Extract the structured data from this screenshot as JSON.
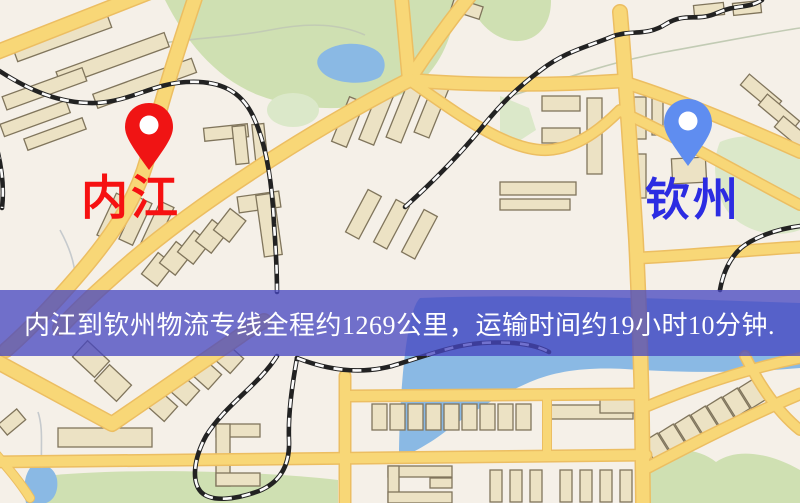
{
  "map": {
    "origin": {
      "label": "内江",
      "pin_color": "#f01414",
      "label_color": "#f61111"
    },
    "destination": {
      "label": "钦州",
      "pin_color": "#5f8df0",
      "label_color": "#2c2ce2"
    },
    "banner": {
      "text": "内江到钦州物流专线全程约1269公里，运输时间约19小时10分钟.",
      "distance_text": "约1269公里",
      "duration_text": "约19小时10分钟",
      "bg_color": "#4646c0",
      "text_color": "#ffffff"
    },
    "palette": {
      "background": "#f5f0e8",
      "road": "#f8d777",
      "road_casing": "#ecbe62",
      "greenery": "#cfe0b2",
      "water": "#8ab9e4",
      "building": "#ece2c4",
      "railway": "#222222"
    }
  }
}
